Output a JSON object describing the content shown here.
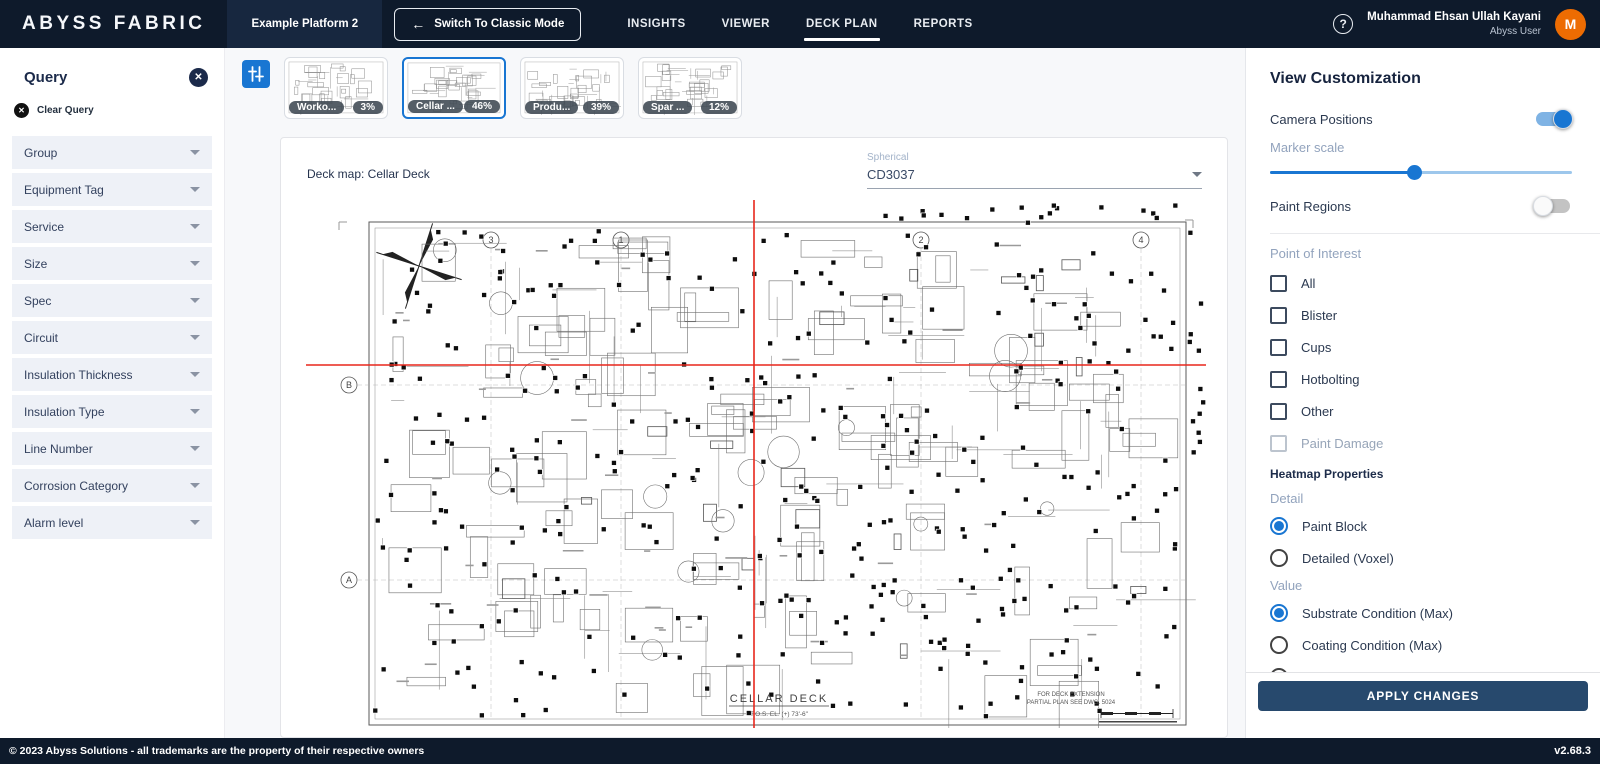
{
  "topbar": {
    "logo": "ABYSS FABRIC",
    "platform_button": "Example Platform 2",
    "switch_button": "Switch To Classic Mode",
    "switch_arrow": "←",
    "nav": [
      {
        "label": "INSIGHTS",
        "active": false
      },
      {
        "label": "VIEWER",
        "active": false
      },
      {
        "label": "DECK PLAN",
        "active": true
      },
      {
        "label": "REPORTS",
        "active": false
      }
    ],
    "help_icon": "?",
    "user": {
      "name": "Muhammad Ehsan Ullah Kayani",
      "role": "Abyss User",
      "avatar_initial": "M",
      "avatar_color": "#ed6c02"
    }
  },
  "query_panel": {
    "title": "Query",
    "close_icon": "✕",
    "clear_icon": "✕",
    "clear_label": "Clear Query",
    "filters": [
      "Group",
      "Equipment Tag",
      "Service",
      "Size",
      "Spec",
      "Circuit",
      "Insulation Thickness",
      "Insulation Type",
      "Line Number",
      "Corrosion Category",
      "Alarm level"
    ]
  },
  "deck_thumbnails": [
    {
      "label": "Worko...",
      "percent": "3%",
      "selected": false
    },
    {
      "label": "Cellar ...",
      "percent": "46%",
      "selected": true
    },
    {
      "label": "Produ...",
      "percent": "39%",
      "selected": false
    },
    {
      "label": "Spar ...",
      "percent": "12%",
      "selected": false
    }
  ],
  "map_card": {
    "title": "Deck map: Cellar Deck",
    "spherical_label": "Spherical",
    "spherical_value": "CD3037",
    "drawing": {
      "title": "CELLAR DECK",
      "elevation": "T.O.S. EL. (+) 73'-6\"",
      "extension_note_1": "FOR DECK EXTENSION",
      "extension_note_2": "PARTIAL PLAN SEE DWG. 5024",
      "grid_cols": [
        "3",
        "1",
        "2",
        "4"
      ],
      "grid_rows": [
        "B",
        "A"
      ]
    }
  },
  "view_panel": {
    "title": "View Customization",
    "camera_positions": {
      "label": "Camera Positions",
      "on": true
    },
    "marker_scale": {
      "label": "Marker scale",
      "value_pct": 47
    },
    "paint_regions": {
      "label": "Paint Regions",
      "on": false
    },
    "poi": {
      "label": "Point of Interest",
      "options": [
        {
          "label": "All",
          "checked": false,
          "disabled": false
        },
        {
          "label": "Blister",
          "checked": false,
          "disabled": false
        },
        {
          "label": "Cups",
          "checked": false,
          "disabled": false
        },
        {
          "label": "Hotbolting",
          "checked": false,
          "disabled": false
        },
        {
          "label": "Other",
          "checked": false,
          "disabled": false
        },
        {
          "label": "Paint Damage",
          "checked": false,
          "disabled": true
        }
      ]
    },
    "heatmap": {
      "title": "Heatmap Properties",
      "detail_label": "Detail",
      "detail_options": [
        {
          "label": "Paint Block",
          "selected": true
        },
        {
          "label": "Detailed (Voxel)",
          "selected": false
        }
      ],
      "value_label": "Value",
      "value_options": [
        {
          "label": "Substrate Condition (Max)",
          "selected": true
        },
        {
          "label": "Coating Condition (Max)",
          "selected": false
        },
        {
          "label": "Trace",
          "selected": false
        }
      ]
    },
    "apply_button": "APPLY CHANGES"
  },
  "footer": {
    "left": "© 2023 Abyss Solutions - all trademarks are the property of their respective owners",
    "version": "v2.68.3"
  },
  "colors": {
    "accent": "#1976d2",
    "topbar": "#0e1a2b",
    "crosshair": "#e8271c"
  }
}
